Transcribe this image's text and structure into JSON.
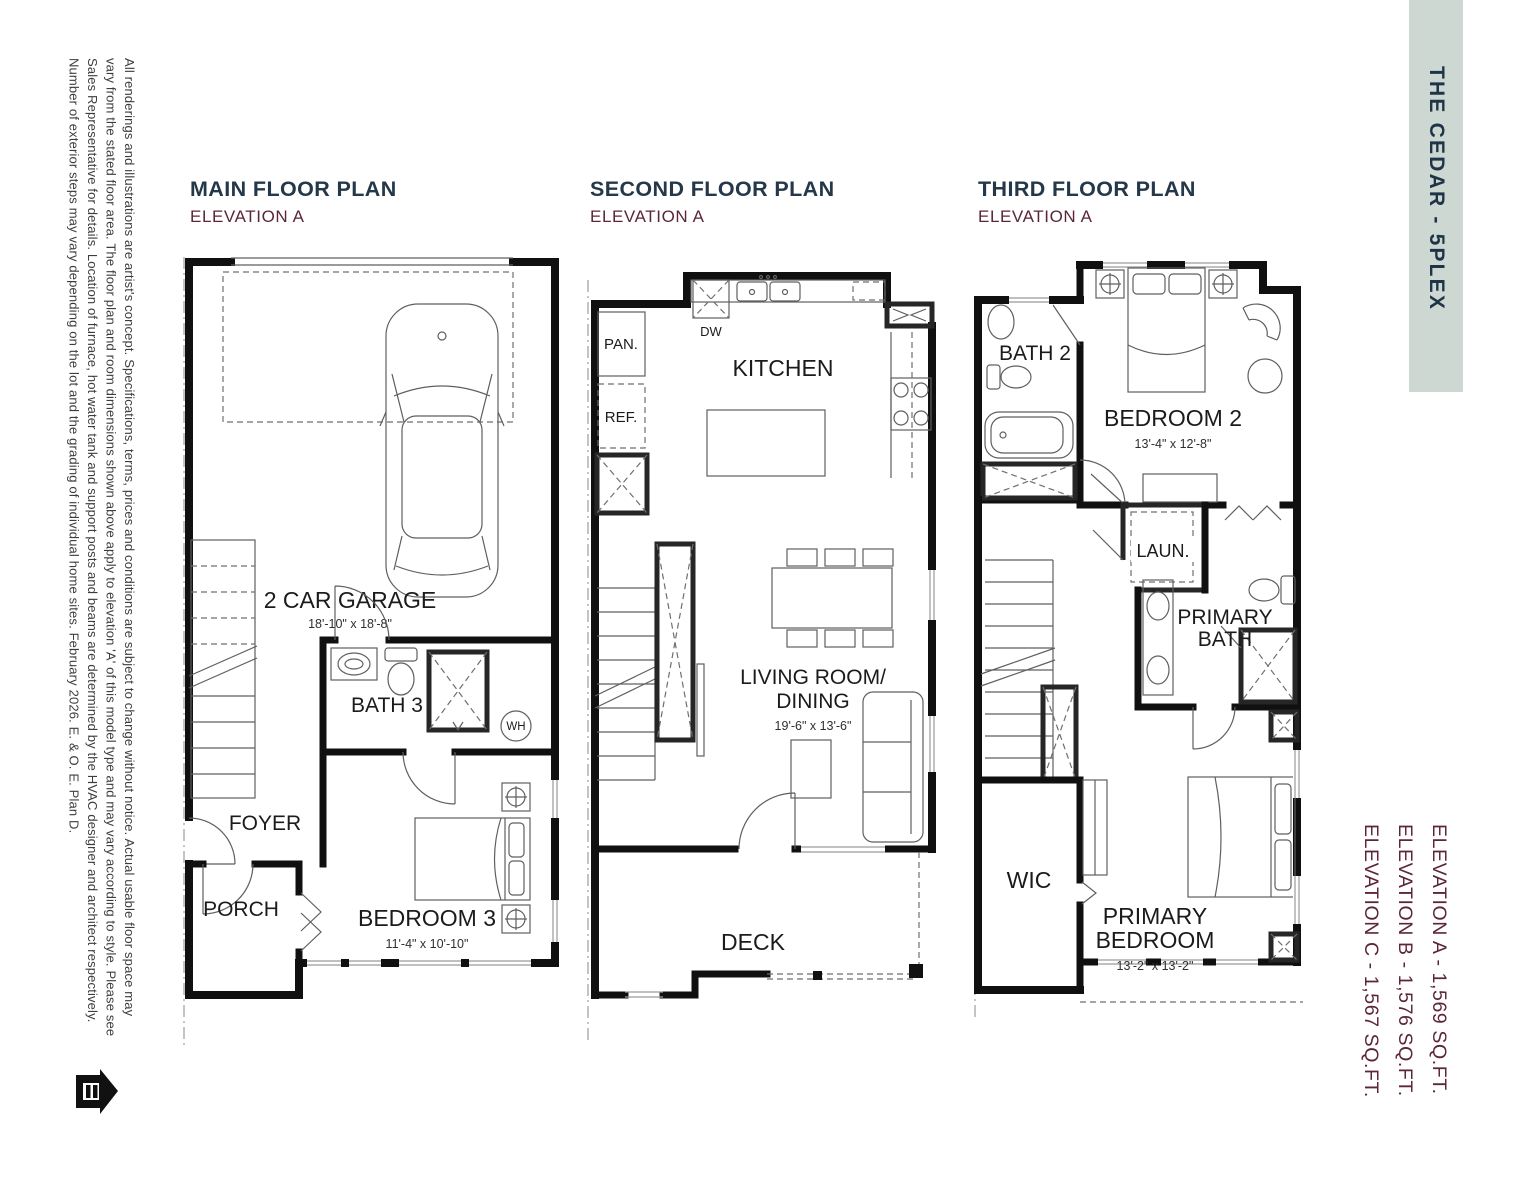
{
  "banner": {
    "label": "THE CEDAR - 5PLEX"
  },
  "footer_elevations": [
    "ELEVATION A - 1,569 SQ.FT.",
    "ELEVATION B - 1,576 SQ.FT.",
    "ELEVATION C - 1,567 SQ.FT."
  ],
  "disclaimer": {
    "lines": [
      "All renderings and illustrations are artist's concept. Specifications, terms, prices and conditions are subject to change without notice. Actual usable floor space may",
      "vary from the stated floor area. The floor plan and room dimensions shown above apply to elevation 'A' of this model type and may vary according to style. Please see",
      "Sales Representative for details. Location of furnace, hot water tank and support posts and beams are determined by the HVAC designer and architect respectively.",
      "Number of exterior steps may vary depending on the lot and the grading of individual home sites. February 2026. E. & O. E. Plan D."
    ]
  },
  "plans": [
    {
      "title": "MAIN FLOOR PLAN",
      "elevation": "ELEVATION A",
      "labels": {
        "garage": "2 CAR GARAGE",
        "garage_dims": "18'-10\" x 18'-8\"",
        "bath": "BATH 3",
        "wh": "WH",
        "foyer": "FOYER",
        "porch": "PORCH",
        "bedroom": "BEDROOM 3",
        "bedroom_dims": "11'-4\" x 10'-10\""
      }
    },
    {
      "title": "SECOND FLOOR PLAN",
      "elevation": "ELEVATION A",
      "labels": {
        "pantry": "PAN.",
        "fridge": "REF.",
        "dishwasher": "DW",
        "kitchen": "KITCHEN",
        "living_line1": "LIVING ROOM/",
        "living_line2": "DINING",
        "living_dims": "19'-6\" x 13'-6\"",
        "deck": "DECK"
      }
    },
    {
      "title": "THIRD FLOOR PLAN",
      "elevation": "ELEVATION A",
      "labels": {
        "bath2": "BATH 2",
        "bedroom2": "BEDROOM 2",
        "bedroom2_dims": "13'-4\" x 12'-8\"",
        "laundry": "LAUN.",
        "primary_bath_line1": "PRIMARY",
        "primary_bath_line2": "BATH",
        "wic": "WIC",
        "primary_bedroom_line1": "PRIMARY",
        "primary_bedroom_line2": "BEDROOM",
        "primary_bedroom_dims": "13'-2\" x 13'-2\""
      }
    }
  ],
  "colors": {
    "banner_bg": "#cdd8d3",
    "banner_text": "#1f3447",
    "title_navy": "#24384a",
    "accent_maroon": "#5c2637",
    "wall_black": "#101010"
  }
}
